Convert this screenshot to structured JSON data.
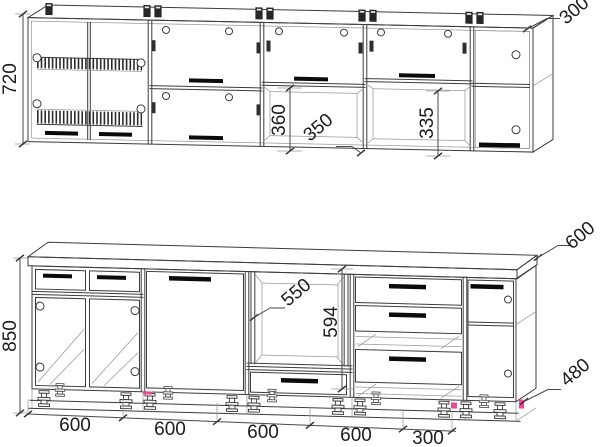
{
  "colors": {
    "background": "#ffffff",
    "line": "#3c3c3c",
    "light_line": "#9a9a9a",
    "handle": "#0b0b0b",
    "text": "#1d1d1d",
    "marker": "#ec4899"
  },
  "dims": {
    "upper": {
      "height": "720",
      "end_unit_width": "300",
      "door_section_height": "360",
      "cabinet_depth": "350",
      "open_niche_height": "335"
    },
    "lower": {
      "height": "850",
      "worktop_depth": "600",
      "niche_depth": "550",
      "niche_height": "594",
      "end_unit_depth": "480",
      "widths": [
        "600",
        "600",
        "600",
        "600",
        "300"
      ]
    }
  }
}
